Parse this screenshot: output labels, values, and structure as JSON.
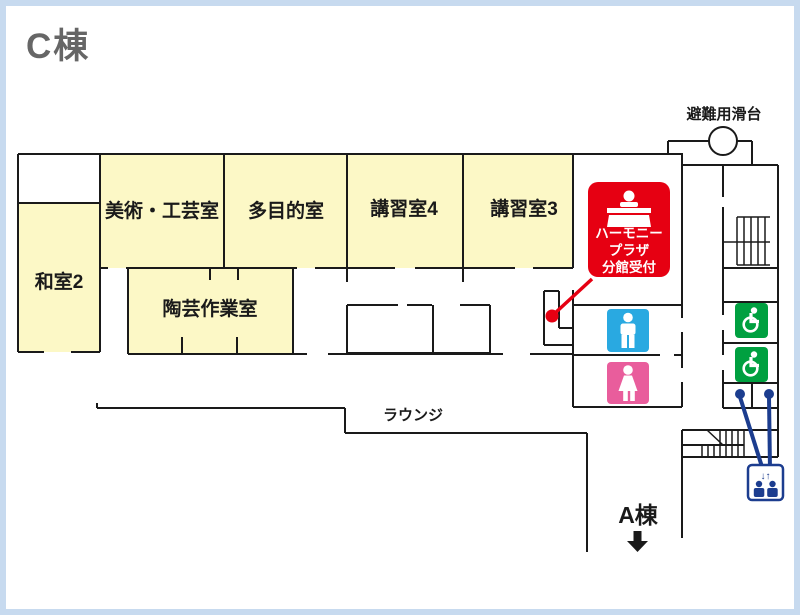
{
  "map": {
    "building_label": "C棟",
    "rooms": [
      {
        "id": "washitsu2",
        "label": "和室2"
      },
      {
        "id": "art-craft",
        "label": "美術・工芸室"
      },
      {
        "id": "multipurpose",
        "label": "多目的室"
      },
      {
        "id": "seminar4",
        "label": "講習室4"
      },
      {
        "id": "seminar3",
        "label": "講習室3"
      },
      {
        "id": "pottery",
        "label": "陶芸作業室"
      }
    ],
    "areas": {
      "lounge": "ラウンジ",
      "evacuation_slide": "避難用滑台",
      "building_a": "A棟"
    },
    "reception": {
      "lines": [
        "ハーモニー",
        "プラザ",
        "分館受付"
      ]
    },
    "icons": {
      "reception_desk": "reception-desk-icon",
      "mens_toilet": "mens-toilet-icon",
      "womens_toilet": "womens-toilet-icon",
      "accessible_toilet": "wheelchair-icon",
      "elevator": "elevator-icon",
      "building_a_arrow": "down-arrow-icon",
      "elevator_arrows_glyph": "↓↑"
    },
    "colors": {
      "frame_blue": "#C7DAEF",
      "wall": "#1A1A1A",
      "room_fill": "#FCF8C6",
      "title_gray": "#666666",
      "reception_red": "#E60012",
      "toilet_male_blue": "#29A9E1",
      "toilet_female_pink": "#E95D9C",
      "accessible_green": "#00A040",
      "elevator_blue": "#1C3D8F"
    }
  }
}
